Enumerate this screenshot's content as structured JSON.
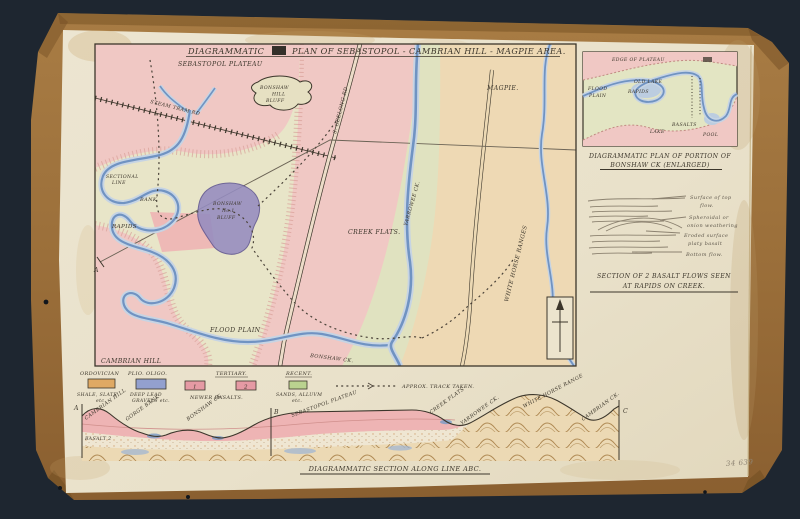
{
  "colors": {
    "background": "#232c37",
    "folder": "#a3753f",
    "folder_dark": "#7c5527",
    "paper": "#ebe4cf",
    "ink": "#3c362b",
    "pink": "#f0c8c4",
    "green": "#e4e4c4",
    "tan": "#eed9b4",
    "river": "#7093c2",
    "river_casing": "#c6d4e4",
    "purple": "#958cc0"
  },
  "map": {
    "title_word": "DIAGRAMMATIC",
    "title_rest": "PLAN OF SEBASTOPOL - CAMBRIAN HILL - MAGPIE AREA.",
    "labels": {
      "plateau": "SEBASTOPOL PLATEAU",
      "bonshaw_hill_1": "BONSHAW",
      "bonshaw_hill_2": "HILL",
      "bonshaw_hill_3": "BLUFF",
      "magpie": "MAGPIE.",
      "geelong_rd": "S. GEELONG RD",
      "steam_tram": "STEAM TRAM RD",
      "sectional_1": "SECTIONAL",
      "sectional_2": "LINE",
      "bank": "BANK",
      "rapids": "RAPIDS",
      "bluff1_1": "BONSHAW",
      "bluff1_2": "No.1",
      "bluff1_3": "BLUFF",
      "point_a": "A",
      "creek_flats": "CREEK FLATS.",
      "yarrowee": "YARROWEE CK.",
      "white_horse": "WHITE HORSE RANGES",
      "flood_plain": "FLOOD PLAIN",
      "cambrian_hill": "CAMBRIAN HILL",
      "bonshaw_ck": "BONSHAW CK."
    }
  },
  "inset": {
    "caption_1": "DIAGRAMMATIC PLAN OF PORTION OF",
    "caption_2": "BONSHAW CK (ENLARGED)",
    "labels": {
      "edge": "EDGE OF PLATEAU",
      "flood_1": "FLOOD",
      "flood_2": "PLAIN",
      "old_lake": "OLD LAKE",
      "rapids": "RAPIDS",
      "basalts": "BASALTS",
      "lake": "LAKE",
      "pool": "POOL"
    }
  },
  "flow_section": {
    "l1a": "Surface of top",
    "l1b": "flow.",
    "l2a": "Spheroidal or",
    "l2b": "onion weathering",
    "l3a": "Eroded surface",
    "l3b": "platy basalt",
    "l4": "Bottom flow.",
    "caption_1": "SECTION OF 2 BASALT FLOWS SEEN",
    "caption_2": "AT RAPIDS ON CREEK."
  },
  "legend": {
    "items": [
      {
        "era": "ORDOVICIAN",
        "line1": "SHALE, SLATE",
        "line2": "etc.",
        "color": "#dfa964"
      },
      {
        "era": "PLIO. OLIGO.",
        "line1": "DEEP LEAD",
        "line2": "GRAVELS etc.",
        "color": "#93a0ce"
      },
      {
        "era": "TERTIARY.",
        "line1": "NEWER BASALTS.",
        "line2": "",
        "color": "#e59aa4",
        "flow_a": "1",
        "flow_b": "2"
      },
      {
        "era": "RECENT.",
        "line1": "SANDS, ALLUVM",
        "line2": "etc.",
        "color": "#bad28f"
      }
    ],
    "track_label": "APPROX. TRACK TAKEN."
  },
  "cross_section": {
    "a": "A",
    "b": "B",
    "c": "C",
    "cambrian_hill": "CAMBRIAN HILL",
    "gorge_bank": "GORGE BANK",
    "bonshaw_ck": "BONSHAW CK.",
    "sebastopol": "SEBASTOPOL PLATEAU",
    "creek_flats": "CREEK FLATS",
    "yarrowee": "YARROWEE CK.",
    "white_horse": "WHITE HORSE RANGE",
    "cambrian_ck": "CAMBRIAN CK.",
    "basalt": "BASALT 2",
    "caption": "DIAGRAMMATIC SECTION ALONG LINE ABC."
  },
  "note": {
    "accession": "34 639"
  }
}
